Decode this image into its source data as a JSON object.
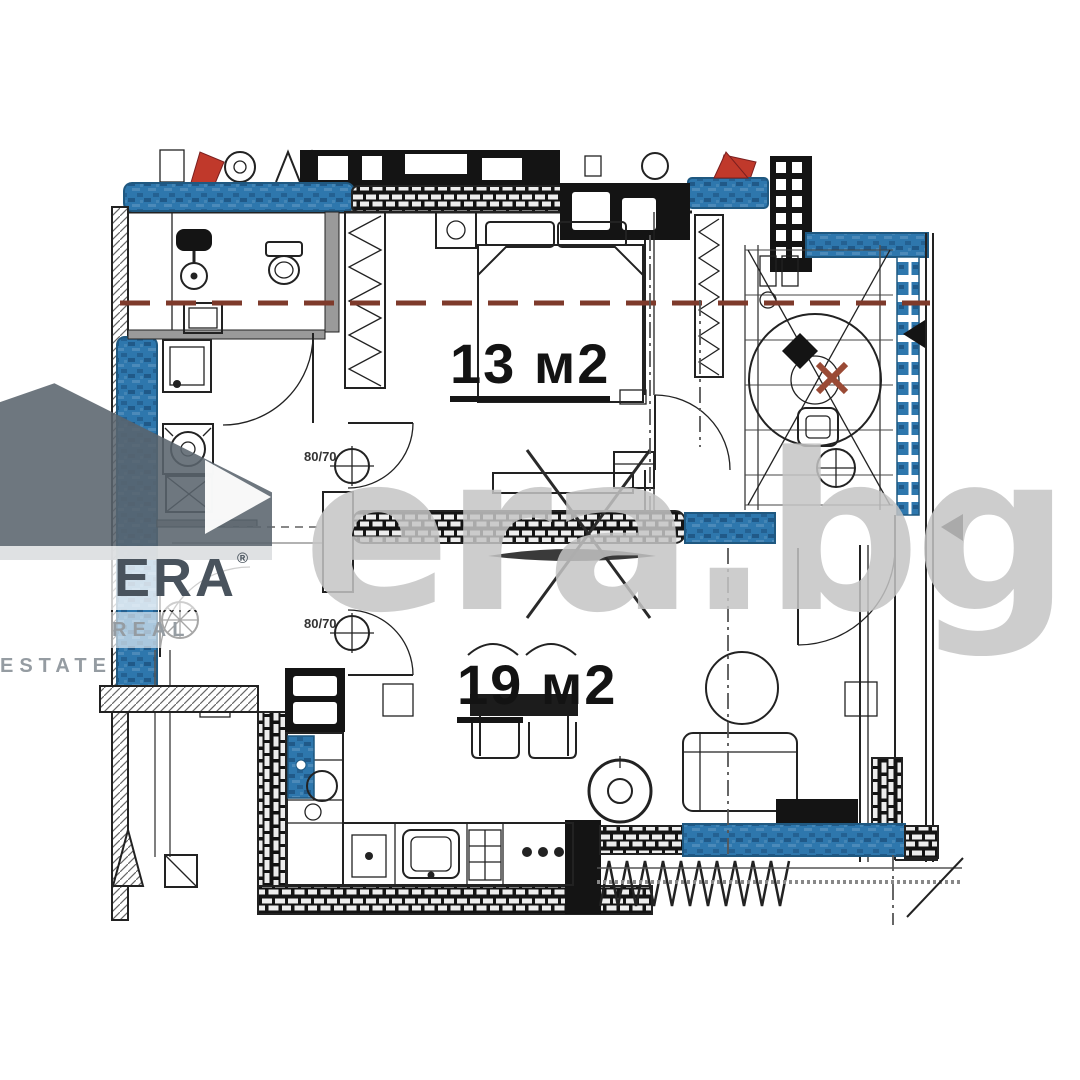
{
  "floorplan": {
    "rooms": [
      {
        "id": "bedroom",
        "area_value": "13",
        "area_unit": " м2"
      },
      {
        "id": "living-room",
        "area_value": "19",
        "area_unit": " м2"
      }
    ],
    "symbols": {
      "vent_top_label": "80/70",
      "vent_bottom_label": "80/70"
    },
    "colors": {
      "wall-blue": "#2e77ad",
      "wall-blue-dark": "#1f5880",
      "wall-black": "#141414",
      "line-ink": "#222222",
      "wall-gray": "#9a9a9a",
      "axis-red": "#7e3a2b",
      "marker-red": "#c0392b",
      "marker-brown": "#9a4a35",
      "watermark-gray": "#b4b4b4",
      "logo-slate": "#5a646d",
      "logo-text": "#49535d",
      "logo-tagline": "#959ca2"
    }
  },
  "watermarks": {
    "agency": {
      "name": "ERA",
      "registered_mark": "®",
      "tagline": "REAL ESTATE"
    },
    "site": "era.bg"
  }
}
